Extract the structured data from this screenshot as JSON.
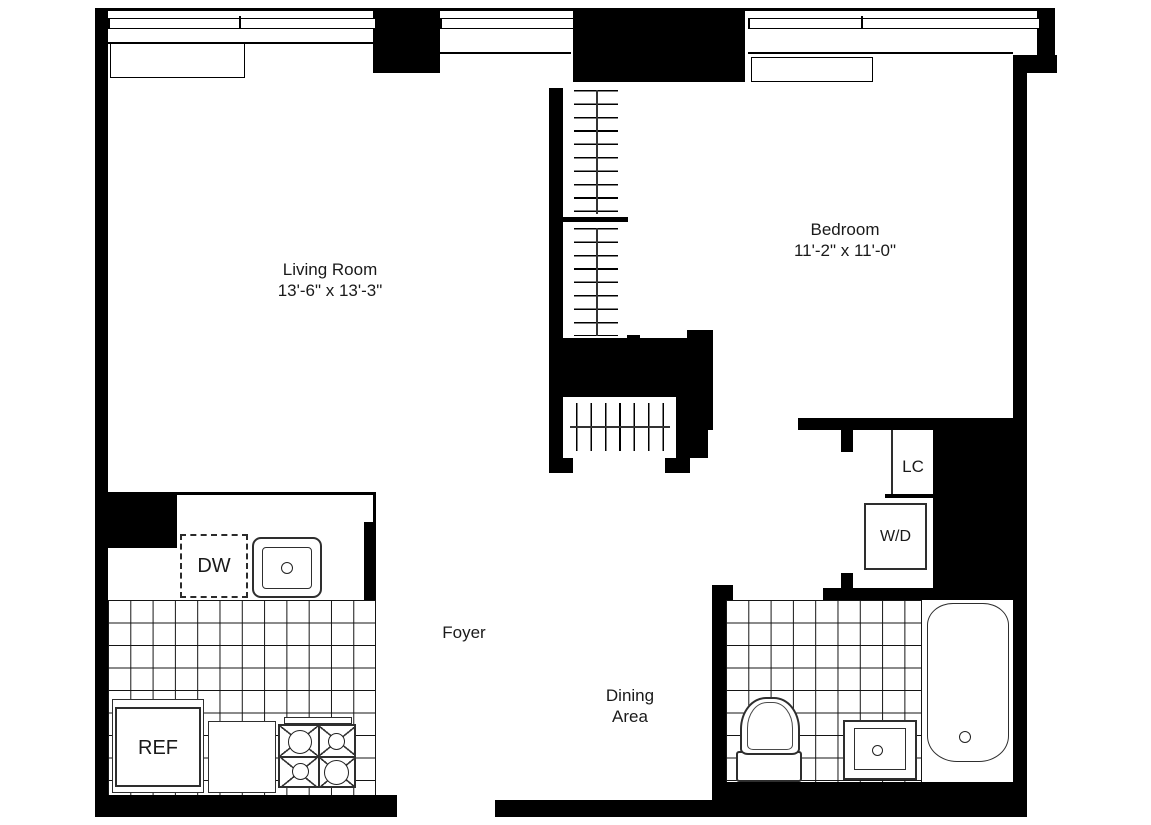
{
  "plan": {
    "type": "apartment-floor-plan",
    "rooms": {
      "living_room": {
        "name": "Living Room",
        "dims": "13'-6\" x 13'-3\""
      },
      "bedroom": {
        "name": "Bedroom",
        "dims": "11'-2\" x 11'-0\""
      },
      "foyer": {
        "name": "Foyer"
      },
      "dining_area": {
        "line1": "Dining",
        "line2": "Area"
      }
    },
    "fixtures": {
      "dishwasher": "DW",
      "refrigerator": "REF",
      "linen_closet": "LC",
      "washer_dryer": "W/D"
    },
    "colors": {
      "wall": "#000000",
      "bg": "#ffffff",
      "tile_line": "#141414",
      "fixture_line": "#2e2e2e",
      "text": "#1a1a1a"
    }
  }
}
